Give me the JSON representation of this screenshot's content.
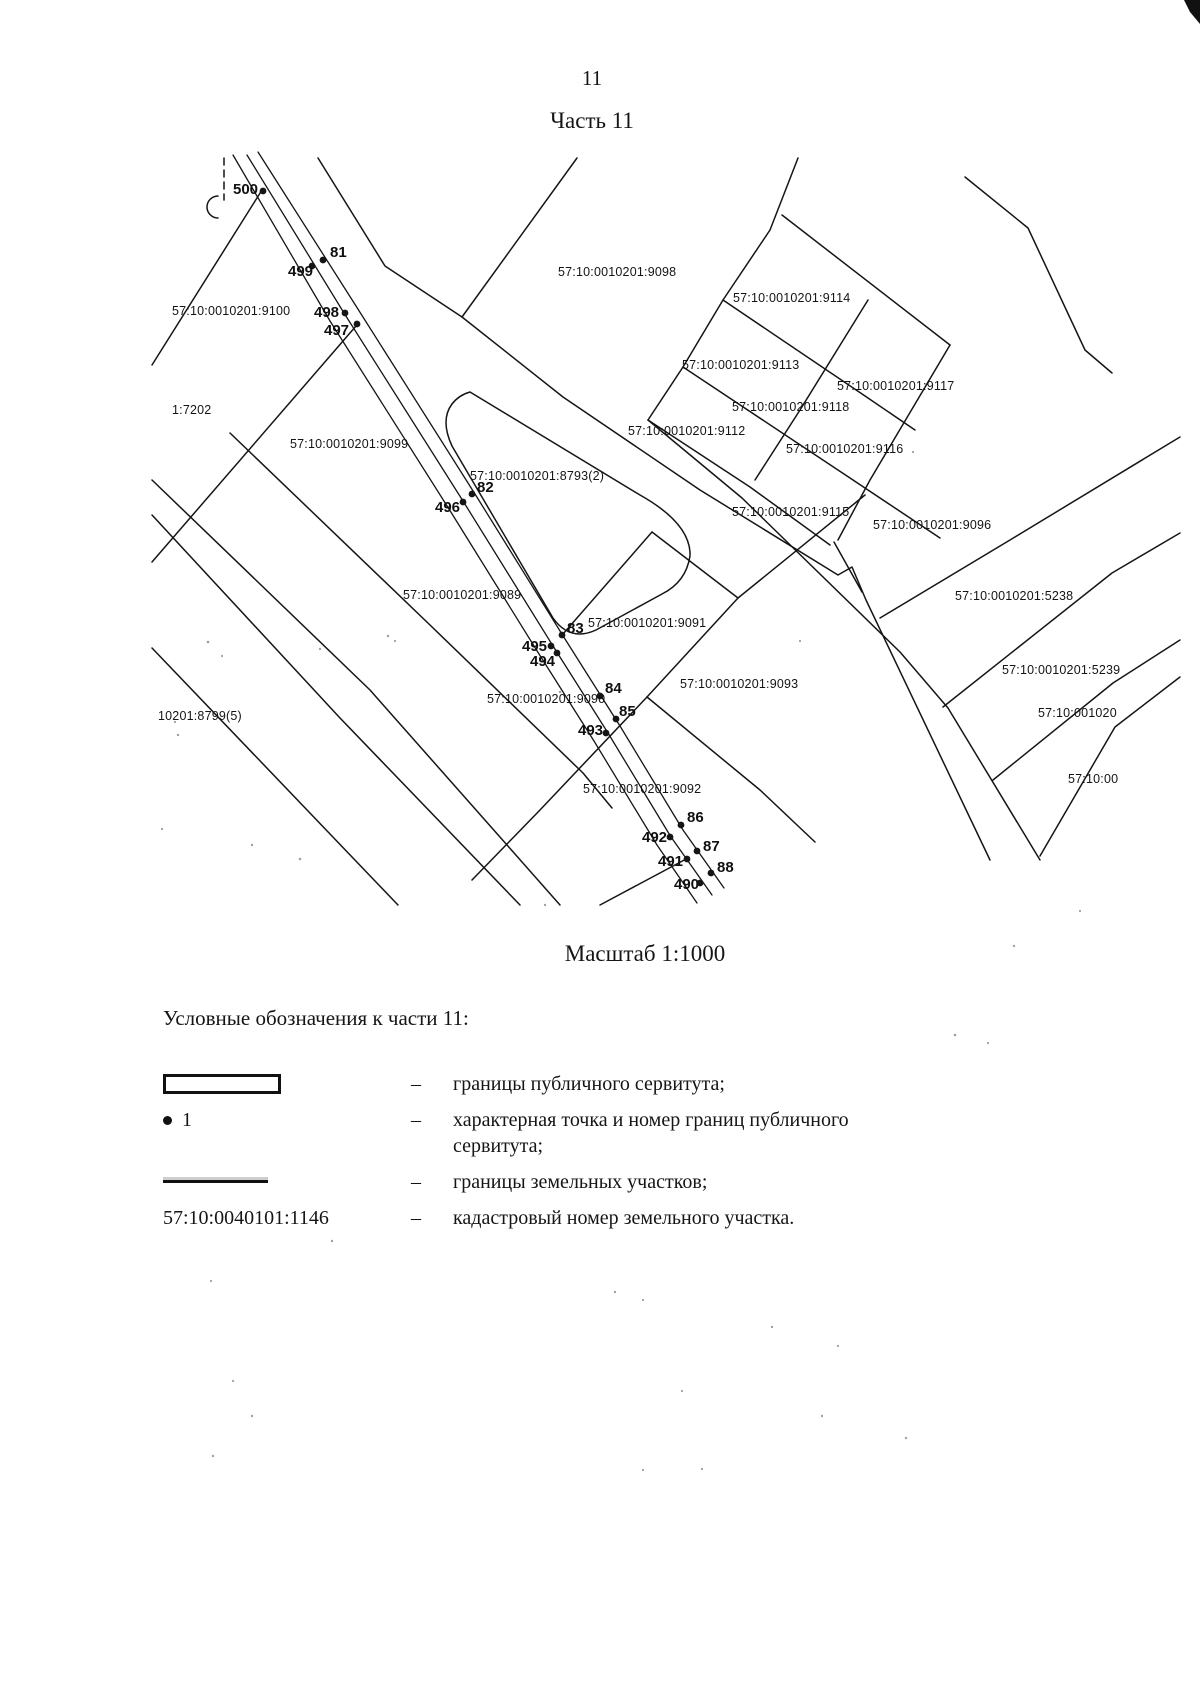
{
  "colors": {
    "ink": "#151515",
    "paper": "#ffffff"
  },
  "header": {
    "page_number": "11",
    "title": "Часть 11"
  },
  "map": {
    "scale_caption": "Масштаб 1:1000",
    "parcel_labels": [
      {
        "text": "57:10:0010201:9100",
        "x": 172,
        "y": 312
      },
      {
        "text": "1:7202",
        "x": 172,
        "y": 411
      },
      {
        "text": "57:10:0010201:9099",
        "x": 290,
        "y": 445
      },
      {
        "text": "57:10:0010201:9098",
        "x": 558,
        "y": 273
      },
      {
        "text": "57:10:0010201:9114",
        "x": 733,
        "y": 299
      },
      {
        "text": "57:10:0010201:9113",
        "x": 682,
        "y": 366
      },
      {
        "text": "57:10:0010201:9117",
        "x": 837,
        "y": 387
      },
      {
        "text": "57:10:0010201:9118",
        "x": 732,
        "y": 408
      },
      {
        "text": "57:10:0010201:9112",
        "x": 628,
        "y": 432
      },
      {
        "text": "57:10:0010201:9116",
        "x": 786,
        "y": 450
      },
      {
        "text": "57:10:0010201:9115",
        "x": 732,
        "y": 513
      },
      {
        "text": "57:10:0010201:9096",
        "x": 873,
        "y": 526
      },
      {
        "text": "57:10:0010201:8793(2)",
        "x": 470,
        "y": 477
      },
      {
        "text": "57:10:0010201:9089",
        "x": 403,
        "y": 596
      },
      {
        "text": "57:10:0010201:9091",
        "x": 588,
        "y": 624
      },
      {
        "text": "57:10:0010201:9093",
        "x": 680,
        "y": 685
      },
      {
        "text": "57:10:0010201:9090",
        "x": 487,
        "y": 700
      },
      {
        "text": "10201:8799(5)",
        "x": 158,
        "y": 717
      },
      {
        "text": "57:10:0010201:9092",
        "x": 583,
        "y": 790
      },
      {
        "text": "57:10:0010201:5238",
        "x": 955,
        "y": 597
      },
      {
        "text": "57:10:0010201:5239",
        "x": 1002,
        "y": 671
      },
      {
        "text": "57:10:001020",
        "x": 1038,
        "y": 714
      },
      {
        "text": "57:10:00",
        "x": 1068,
        "y": 780
      }
    ],
    "point_labels": [
      {
        "text": "500",
        "x": 233,
        "y": 190,
        "dot_x": 263,
        "dot_y": 191
      },
      {
        "text": "81",
        "x": 330,
        "y": 253,
        "dot_x": 323,
        "dot_y": 260
      },
      {
        "text": "499",
        "x": 288,
        "y": 272,
        "dot_x": 312,
        "dot_y": 266
      },
      {
        "text": "498",
        "x": 314,
        "y": 313,
        "dot_x": 345,
        "dot_y": 313
      },
      {
        "text": "497",
        "x": 324,
        "y": 331,
        "dot_x": 357,
        "dot_y": 324
      },
      {
        "text": "82",
        "x": 477,
        "y": 488,
        "dot_x": 472,
        "dot_y": 494
      },
      {
        "text": "496",
        "x": 435,
        "y": 508,
        "dot_x": 463,
        "dot_y": 502
      },
      {
        "text": "83",
        "x": 567,
        "y": 629,
        "dot_x": 562,
        "dot_y": 635
      },
      {
        "text": "495",
        "x": 522,
        "y": 647,
        "dot_x": 551,
        "dot_y": 646
      },
      {
        "text": "494",
        "x": 530,
        "y": 662,
        "dot_x": 557,
        "dot_y": 653
      },
      {
        "text": "84",
        "x": 605,
        "y": 689,
        "dot_x": 600,
        "dot_y": 696
      },
      {
        "text": "85",
        "x": 619,
        "y": 712,
        "dot_x": 616,
        "dot_y": 719
      },
      {
        "text": "493",
        "x": 578,
        "y": 731,
        "dot_x": 606,
        "dot_y": 733
      },
      {
        "text": "86",
        "x": 687,
        "y": 818,
        "dot_x": 681,
        "dot_y": 825
      },
      {
        "text": "492",
        "x": 642,
        "y": 838,
        "dot_x": 670,
        "dot_y": 837
      },
      {
        "text": "87",
        "x": 703,
        "y": 847,
        "dot_x": 697,
        "dot_y": 851
      },
      {
        "text": "491",
        "x": 658,
        "y": 862,
        "dot_x": 687,
        "dot_y": 859
      },
      {
        "text": "88",
        "x": 717,
        "y": 868,
        "dot_x": 711,
        "dot_y": 873
      },
      {
        "text": "490",
        "x": 674,
        "y": 885,
        "dot_x": 700,
        "dot_y": 883
      }
    ]
  },
  "legend": {
    "heading": "Условные обозначения к части 11:",
    "items": [
      {
        "dash": "–",
        "text": "границы публичного сервитута;"
      },
      {
        "dash": "–",
        "symbol_label": "1",
        "text": "характерная точка и номер границ публичного сервитута;"
      },
      {
        "dash": "–",
        "text": "границы земельных участков;"
      },
      {
        "dash": "–",
        "symbol_label": "57:10:0040101:1146",
        "text": "кадастровый номер земельного участка."
      }
    ]
  }
}
